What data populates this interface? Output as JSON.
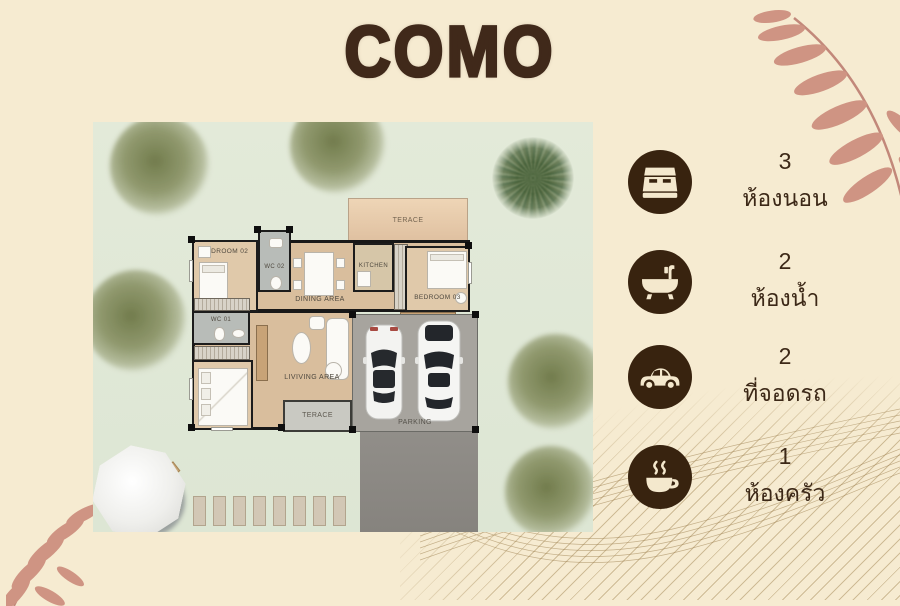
{
  "title": "COMO",
  "amenities": [
    {
      "icon": "bed-icon",
      "count": "3",
      "label": "ห้องนอน"
    },
    {
      "icon": "bath-icon",
      "count": "2",
      "label": "ห้องน้ำ"
    },
    {
      "icon": "car-icon",
      "count": "2",
      "label": "ที่จอดรถ"
    },
    {
      "icon": "coffee-icon",
      "count": "1",
      "label": "ห้องครัว"
    }
  ],
  "floorplan": {
    "labels": {
      "terrace_top": "TERACE",
      "bedroom_02": "BEDROOM 02",
      "wc_02": "WC 02",
      "dining": "DINING AREA",
      "kitchen": "KITCHEN",
      "bedroom_03": "BEDROOM 03",
      "wc_01": "WC 01",
      "living": "LIVIVING AREA",
      "terrace_bottom": "TERACE",
      "parking": "PARKING"
    }
  },
  "colors": {
    "background": "#f6ebd1",
    "title_text": "#40291a",
    "icon_circle": "#38230f",
    "icon_glyph": "#f4e8cd",
    "body_text": "#3c2817",
    "grass": "#dfe7d7",
    "wood_floor": "#d9be9d",
    "terrace_tan": "#e6c9ab",
    "parking_gray": "#a5a29c",
    "driveway_gray": "#8f8c87",
    "leaf_decor": "#cd9484",
    "wave_lines": "#9e804c",
    "tree_green": "#7c8554",
    "palm_green": "#44603a"
  }
}
